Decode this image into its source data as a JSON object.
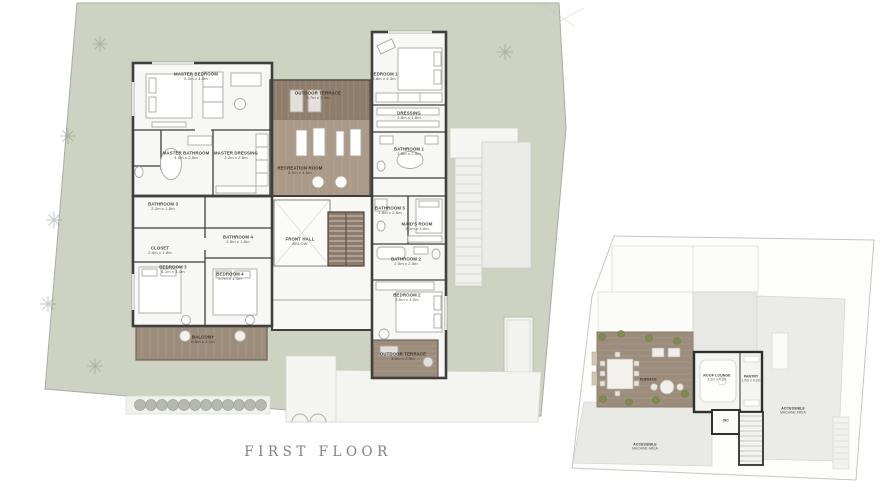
{
  "caption": "FIRST FLOOR",
  "colors": {
    "lawn": "#cdd2c3",
    "wood_dark": "#8f7d6b",
    "wood_mid": "#9c8c7b",
    "wood_light": "#ab9a88",
    "wall": "#3f3f3d",
    "hedge": "#b5b9af",
    "plant": "#7d8d50",
    "paving": "#f3f3f0"
  },
  "main_plan": {
    "rooms": [
      {
        "id": "master-bedroom",
        "name": "MASTER BEDROOM",
        "dims": "5.0m x 4.5m"
      },
      {
        "id": "outdoor-terrace",
        "name": "OUTDOOR TERRACE",
        "dims": "9.7m x 3.2m"
      },
      {
        "id": "bedroom-1",
        "name": "BEDROOM 1",
        "dims": "3.6m x 4.3m"
      },
      {
        "id": "dressing",
        "name": "DRESSING",
        "dims": "1.8m x 1.8m"
      },
      {
        "id": "master-bathroom",
        "name": "MASTER BATHROOM",
        "dims": "4.0m x 2.5m"
      },
      {
        "id": "master-dressing",
        "name": "MASTER DRESSING",
        "dims": "2.2m x 2.5m"
      },
      {
        "id": "recreation-room",
        "name": "RECREATION ROOM",
        "dims": "8.0m x 4.5m"
      },
      {
        "id": "bathroom-1",
        "name": "BATHROOM 1",
        "dims": "2.5m x 2.5m"
      },
      {
        "id": "bathroom-3",
        "name": "BATHROOM 3",
        "dims": "2.2m x 1.8m"
      },
      {
        "id": "bathroom-5",
        "name": "BATHROOM 5",
        "dims": "1.6m x 2.6m"
      },
      {
        "id": "maids-room",
        "name": "MAID'S ROOM",
        "dims": "3.1m x 3.0m"
      },
      {
        "id": "closet",
        "name": "CLOSET",
        "dims": "2.0m x 1.8m"
      },
      {
        "id": "bathroom-4",
        "name": "BATHROOM 4",
        "dims": "2.8m x 1.8m"
      },
      {
        "id": "front-hall",
        "name": "FRONT HALL",
        "dims": "BELOW"
      },
      {
        "id": "bathroom-2",
        "name": "BATHROOM 2",
        "dims": "2.5m x 2.5m"
      },
      {
        "id": "bedroom-3",
        "name": "BEDROOM 3",
        "dims": "4.1m x 4.0m"
      },
      {
        "id": "bedroom-4",
        "name": "BEDROOM 4",
        "dims": "3.7m x 4.1m"
      },
      {
        "id": "bedroom-2",
        "name": "BEDROOM 2",
        "dims": "3.6m x 4.0m"
      },
      {
        "id": "balcony",
        "name": "BALCONY",
        "dims": "6.8m x 2.1m"
      },
      {
        "id": "outdoor-terrace-2",
        "name": "OUTDOOR TERRACE",
        "dims": "4.9m x 2.5m"
      }
    ]
  },
  "roof_plan": {
    "rooms": [
      {
        "id": "terrace",
        "name": "TERRACE",
        "dims": ""
      },
      {
        "id": "roof-lounge",
        "name": "ROOF LOUNGE",
        "dims": "5.2m x 4.2m"
      },
      {
        "id": "pantry",
        "name": "PANTRY",
        "dims": "1.5m x 4.2m"
      },
      {
        "id": "wc",
        "name": "WC",
        "dims": ""
      },
      {
        "id": "machine-area-left",
        "name": "ACCESSIBLE",
        "dims": "MACHINE AREA"
      },
      {
        "id": "machine-area-right",
        "name": "ACCESSIBLE",
        "dims": "MACHINE AREA"
      }
    ]
  }
}
